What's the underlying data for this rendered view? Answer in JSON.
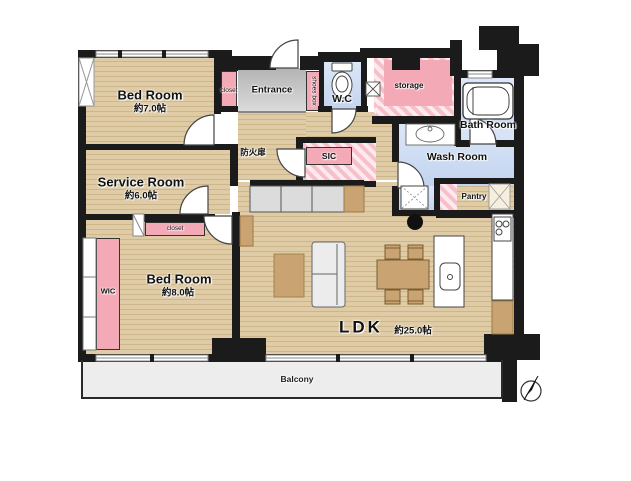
{
  "rooms": {
    "bedroom_a": {
      "label": "Bed Room",
      "size": "約7.0帖"
    },
    "service_room": {
      "label": "Service Room",
      "size": "約6.0帖"
    },
    "bedroom_b": {
      "label": "Bed Room",
      "size": "約8.0帖"
    },
    "ldk": {
      "label": "LDK",
      "size": "約25.0帖"
    },
    "entrance": {
      "label": "Entrance"
    },
    "wc": {
      "label": "W.C"
    },
    "storage": {
      "label": "storage"
    },
    "bath_room": {
      "label": "Bath Room"
    },
    "wash_room": {
      "label": "Wash Room"
    },
    "pantry": {
      "label": "Pantry"
    },
    "balcony": {
      "label": "Balcony"
    },
    "sic": {
      "label": "SIC"
    },
    "wic": {
      "label": "WIC"
    },
    "closet_a": {
      "label": "closet"
    },
    "closet_b": {
      "label": "closet"
    },
    "shoes_box": {
      "label": "shoes box"
    },
    "fire_door": {
      "label": "防火扉"
    }
  },
  "colors": {
    "wall": "#1b1b1b",
    "wood_floor": "#dbc69e",
    "wet_area": "#cdddf4",
    "closet_pink": "#f4a9b6",
    "entrance_gray": "#c7c7c7",
    "balcony_gray": "#ededed"
  }
}
